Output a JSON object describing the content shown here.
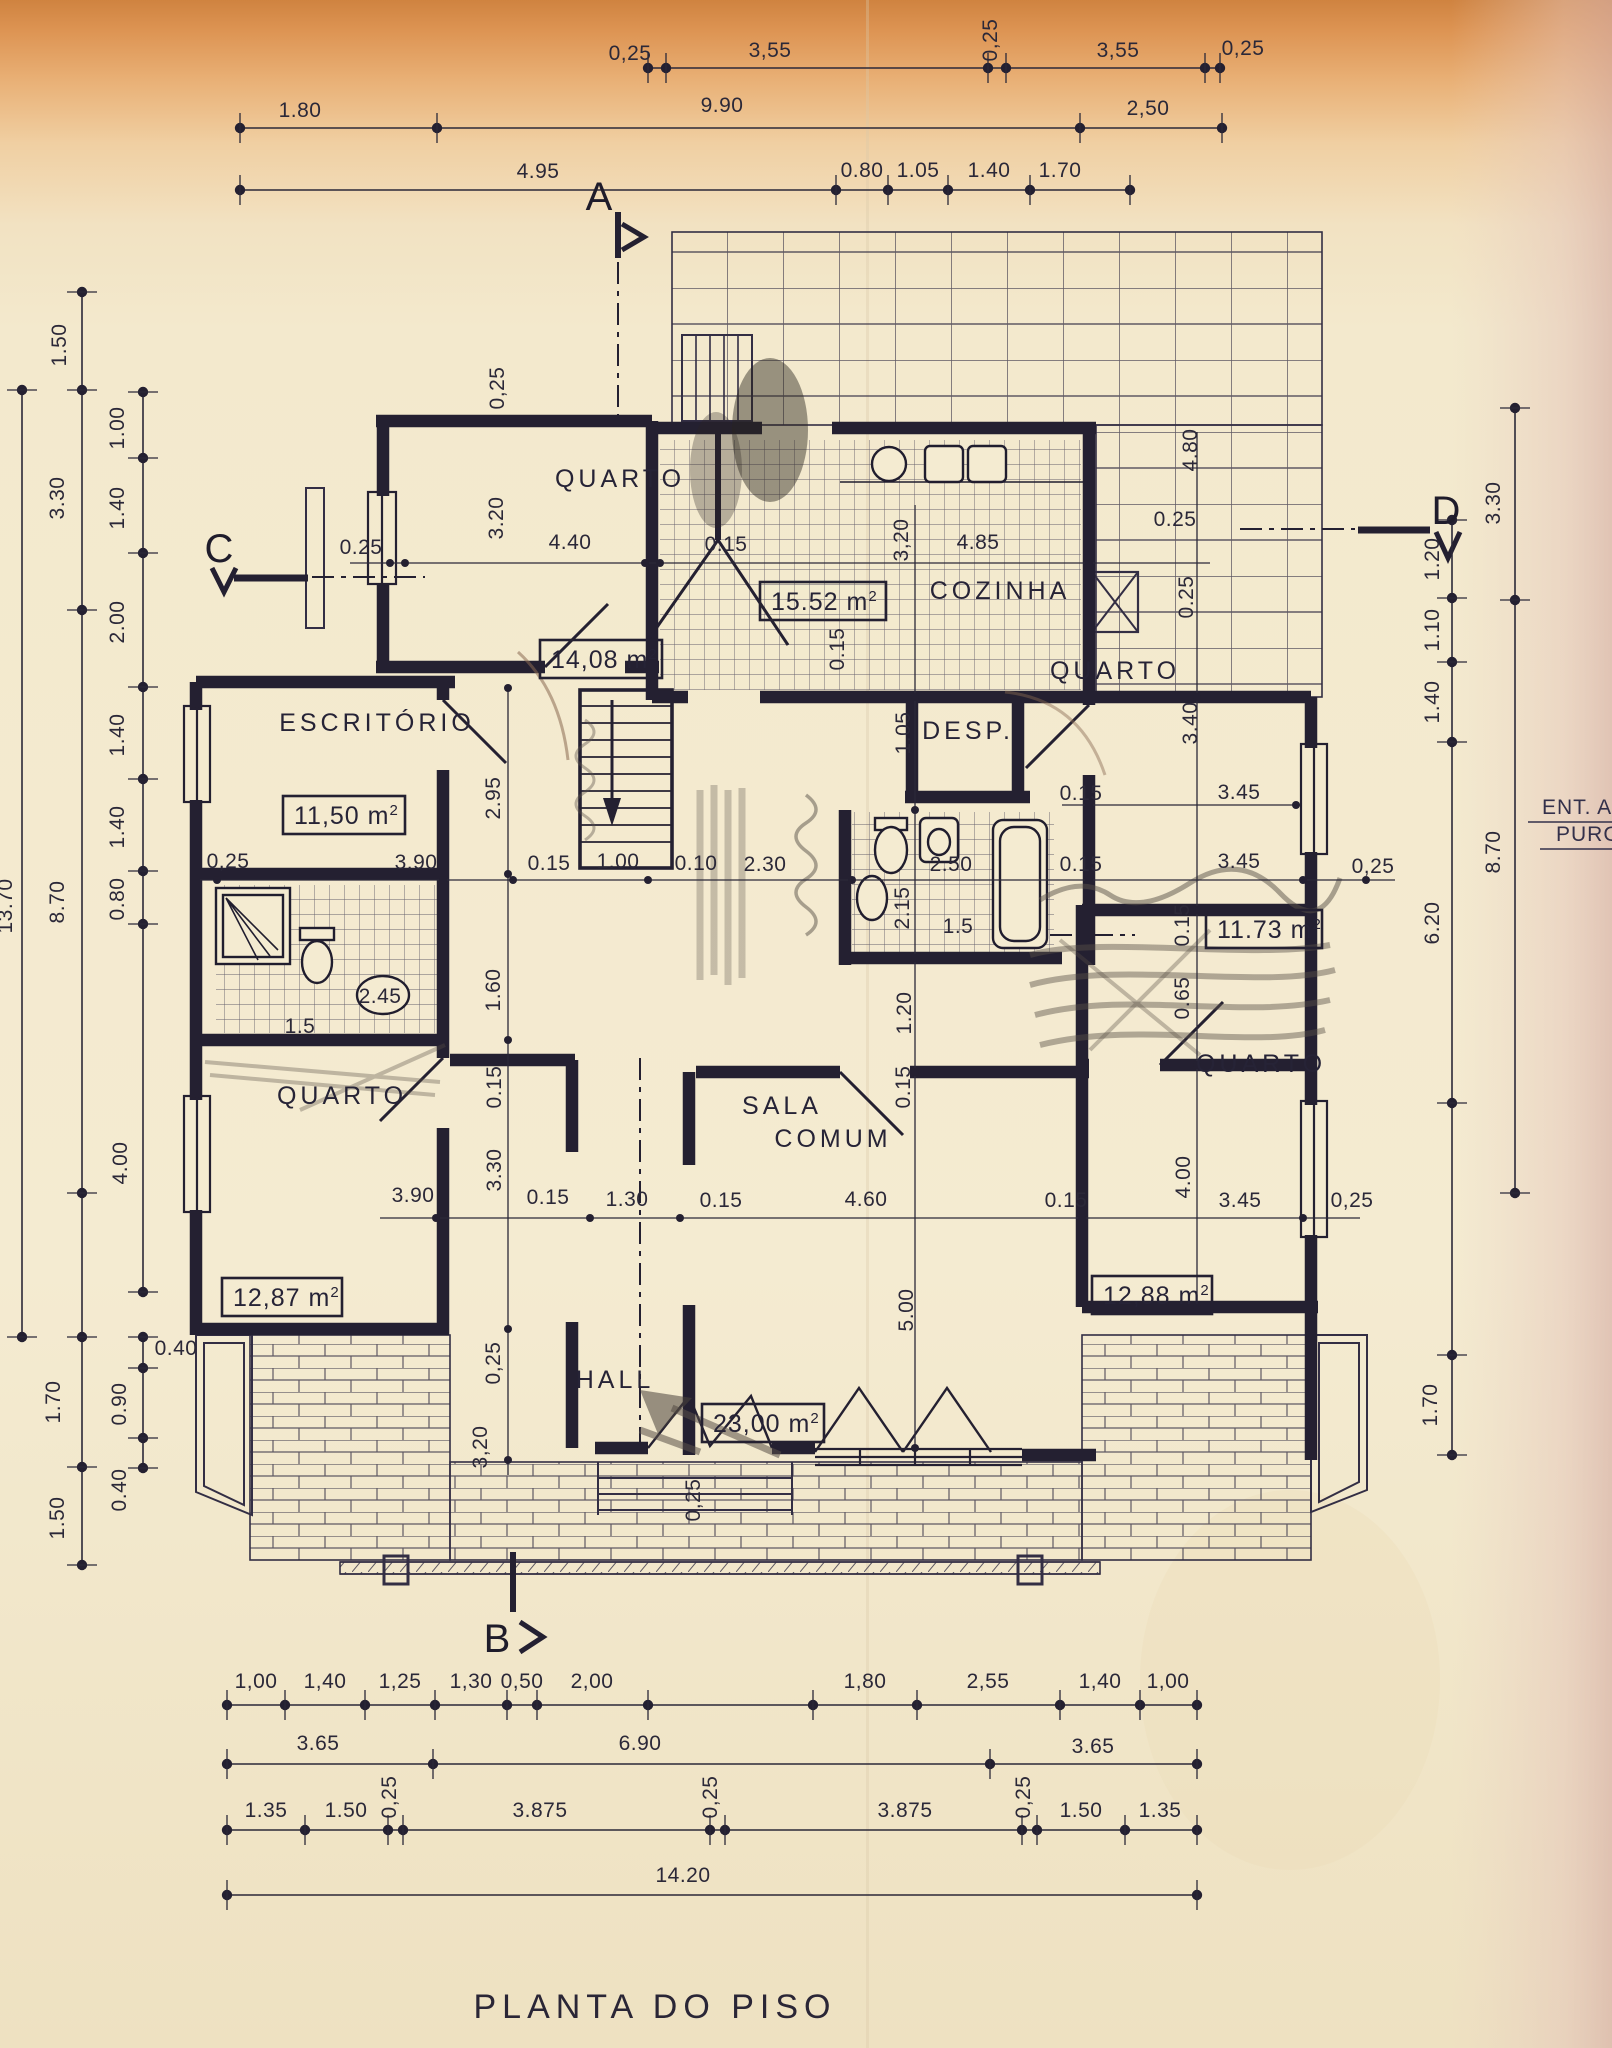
{
  "title": "PLANTA DO PISO",
  "side_note": {
    "line1": "ENT. A",
    "line2": "PURG"
  },
  "markers": {
    "a": "A",
    "b": "B",
    "c": "C",
    "d": "D"
  },
  "m2_sup": "2",
  "rooms": {
    "quarto_tl": {
      "name": "QUARTO",
      "area": "14,08 m"
    },
    "cozinha": {
      "name": "COZINHA",
      "area": "15.52 m"
    },
    "escritorio": {
      "name": "ESCRITÓRIO",
      "area": "11,50 m"
    },
    "desp": {
      "name": "DESP."
    },
    "quarto_tr": {
      "name": "QUARTO",
      "area": "11.73 m"
    },
    "quarto_bl": {
      "name": "QUARTO",
      "area": "12,87 m"
    },
    "quarto_br": {
      "name": "QUARTO",
      "area": "12,88 m"
    },
    "sala": {
      "name_line1": "SALA",
      "name_line2": "COMUM",
      "area": "23,00 m"
    },
    "hall": {
      "name": "HALL"
    }
  },
  "dims": {
    "top1": [
      "0,25",
      "3,55",
      "0,25",
      "3,55",
      "0,25"
    ],
    "top2": [
      "1.80",
      "9.90",
      "2,50"
    ],
    "top3": [
      "4.95",
      "0.80",
      "1.05",
      "1.40",
      "1.70"
    ],
    "left_outer": [
      "13.70"
    ],
    "left_mid": [
      "1.50",
      "3.30",
      "8.70",
      "1.70",
      "1.50"
    ],
    "left_in": [
      "1.00",
      "1.40",
      "2.00",
      "1.40",
      "1.40",
      "0.80",
      "4.00"
    ],
    "left_sub": [
      "0.40",
      "0.90",
      "0.40"
    ],
    "right_out": [
      "3.30",
      "8.70"
    ],
    "right_in": [
      "1.20",
      "1.10",
      "1.40",
      "6.20",
      "1.70"
    ],
    "bot1": [
      "1,00",
      "1,40",
      "1,25",
      "1,30",
      "0,50",
      "2,00",
      "1,80",
      "2,55",
      "1,40",
      "1,00"
    ],
    "bot2": [
      "3.65",
      "6.90",
      "3.65"
    ],
    "bot3": [
      "1.35",
      "1.50",
      "0,25",
      "3.875",
      "0,25",
      "3.875",
      "0,25",
      "1.50",
      "1.35"
    ],
    "bot4": [
      "14.20"
    ],
    "inner": [
      "0,25",
      "0.25",
      "4.40",
      "0.15",
      "4.85",
      "3,20",
      "3.20",
      "0.15",
      "4.80",
      "0.25",
      "0.25",
      "1.05",
      "3.40",
      "0.15",
      "3.45",
      "0,25",
      "3.90",
      "0.15",
      "1.00",
      "0.10",
      "2.30",
      "2.50",
      "0.15",
      "3.45",
      "0,25",
      "2.95",
      "1.60",
      "2.45",
      "1.5",
      "2.15",
      "1.5",
      "0.15",
      "0.65",
      "1.20",
      "3.30",
      "0.15",
      "4.00",
      "5.00",
      "3.90",
      "0.15",
      "1.30",
      "0.15",
      "4.60",
      "0.15",
      "3.45",
      "0,25",
      "0,25",
      "3,20",
      "0,25",
      "0.15"
    ]
  },
  "colors": {
    "ink": "#262336",
    "paper": "#f3e9cd",
    "pencil": "#5a5149",
    "top_tint": "#d08441"
  }
}
